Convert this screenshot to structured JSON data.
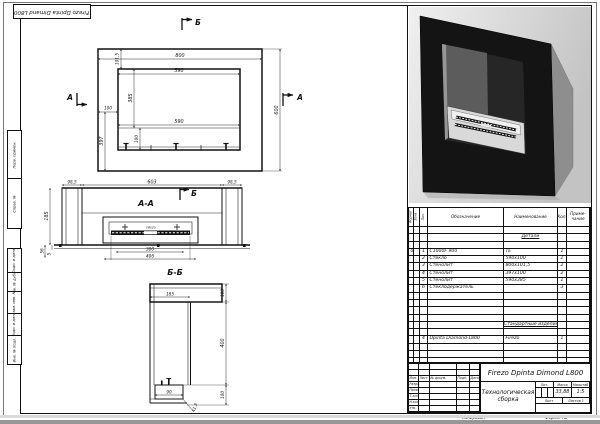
{
  "page": {
    "corner_label": "Firezo Dpinta Dimand L800",
    "copied_label": "Копировал",
    "format_label": "Формат А2"
  },
  "margin_labels": [
    "Перв. примен.",
    "Справ. №",
    "Подп. и дата",
    "Инв. № дубл.",
    "Взам. инв. №",
    "Подп. и дата",
    "Инв. № подл."
  ],
  "front_view": {
    "marker_b": "Б",
    "marker_a_left": "А",
    "marker_a_right": "А",
    "dims": {
      "total_width": "800",
      "frame_top": "101,5",
      "opening_width": "590",
      "total_height": "600",
      "opening_height": "385",
      "frame_side": "100",
      "left_lower": "397",
      "opening_width_lower": "590",
      "burner_zone": "100"
    }
  },
  "section_aa": {
    "title": "А-А",
    "marker_b": "Б",
    "burner_label": "FIREZO",
    "dims": {
      "side_left": "98,5",
      "middle": "603",
      "side_right": "98,5",
      "depth": "185",
      "ledge": "56",
      "lip": "5",
      "burner_width": "300",
      "tray_width": "406"
    }
  },
  "section_bb": {
    "title": "Б-Б",
    "dims": {
      "top_width": "185",
      "top_height": "100",
      "body_height": "400",
      "bottom_height": "100",
      "burner_width": "90",
      "offset": "41,5"
    }
  },
  "spec_table": {
    "headers": {
      "format": "Формат",
      "zone": "Зона",
      "pos": "Поз.",
      "designation": "Обозначение",
      "name": "Наименование",
      "qty": "Кол.",
      "note1": "Приме-",
      "note2": "чание"
    },
    "rows": [
      {},
      {
        "n": "Детали",
        "section": true
      },
      {},
      {
        "f": "0",
        "p": "1",
        "d": "С1000F 900",
        "n": "ТЕ",
        "q": "1"
      },
      {
        "p": "2",
        "d": "Стекло",
        "n": "590х100",
        "q": "1"
      },
      {
        "p": "3",
        "d": "Стенолит",
        "n": "800х101,5",
        "q": "2"
      },
      {
        "p": "4",
        "d": "Стенолит",
        "n": "397х100",
        "q": "2"
      },
      {
        "p": "5",
        "d": "Стенолит",
        "n": "590х385",
        "q": "1"
      },
      {
        "p": "6",
        "d": "Стеклодержатель",
        "q": "3"
      },
      {},
      {},
      {},
      {},
      {
        "n": "Стандартные изделия",
        "section": true
      },
      {},
      {
        "p": "4",
        "d": "Dpinta Diamond-L800",
        "n": "Firezo",
        "q": "1"
      },
      {},
      {},
      {}
    ]
  },
  "title_block": {
    "designation": "Firezo Dpinta Dimond L800",
    "doc_title": "Технологическая сборка",
    "lit_label": "Лит.",
    "mass_label": "Масса",
    "scale_label": "Масштаб",
    "mass": "33,88",
    "scale": "1:5",
    "sheet_label": "Лист",
    "sheets_label": "Листов 1",
    "left_rows": [
      [
        "",
        "",
        "",
        "",
        ""
      ],
      [
        "",
        "",
        "",
        "",
        ""
      ],
      [
        "Изм.",
        "Лист",
        "№ докум.",
        "Подп.",
        "Дата"
      ],
      [
        "Разраб.",
        "",
        "",
        "",
        ""
      ],
      [
        "Пров.",
        "",
        "",
        "",
        ""
      ],
      [
        "Т.контр.",
        "",
        "",
        "",
        ""
      ],
      [
        "Н.контр.",
        "",
        "",
        "",
        ""
      ],
      [
        "Утв.",
        "",
        "",
        "",
        ""
      ]
    ]
  }
}
